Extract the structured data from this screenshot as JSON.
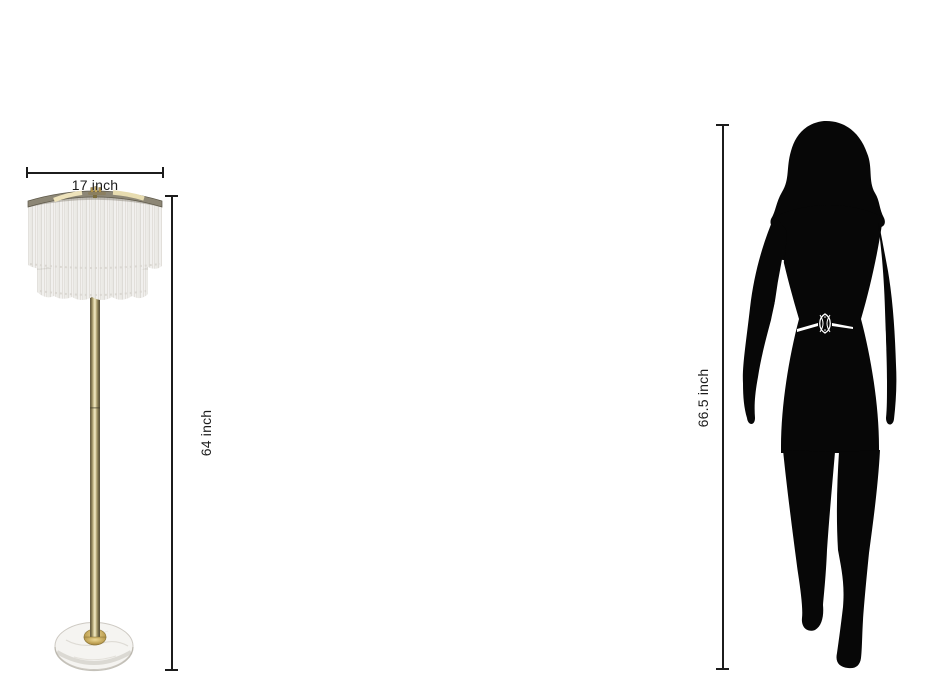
{
  "image": {
    "title": "Floor lamp size comparison",
    "background": "#ffffff"
  },
  "lamp": {
    "name": "two-tier fringe floor lamp with marble base",
    "width_label": "17 inch",
    "height_label": "64 inch",
    "colors": {
      "fringe": "#f3f2f0",
      "fringe_strand": "#dbd8d3",
      "rim": "#8d8776",
      "rim_highlight": "#ece1b8",
      "pole_brass": "#c9bc8a",
      "collar_gold": "#c2a558",
      "base_marble": "#f5f4f1"
    }
  },
  "person": {
    "name": "walking woman silhouette",
    "height_label": "66.5 inch",
    "color": "#070707",
    "belt_color": "#ffffff"
  },
  "dimension_style": {
    "line_color": "#1c1c1c",
    "text_color": "#1c1c1c"
  }
}
